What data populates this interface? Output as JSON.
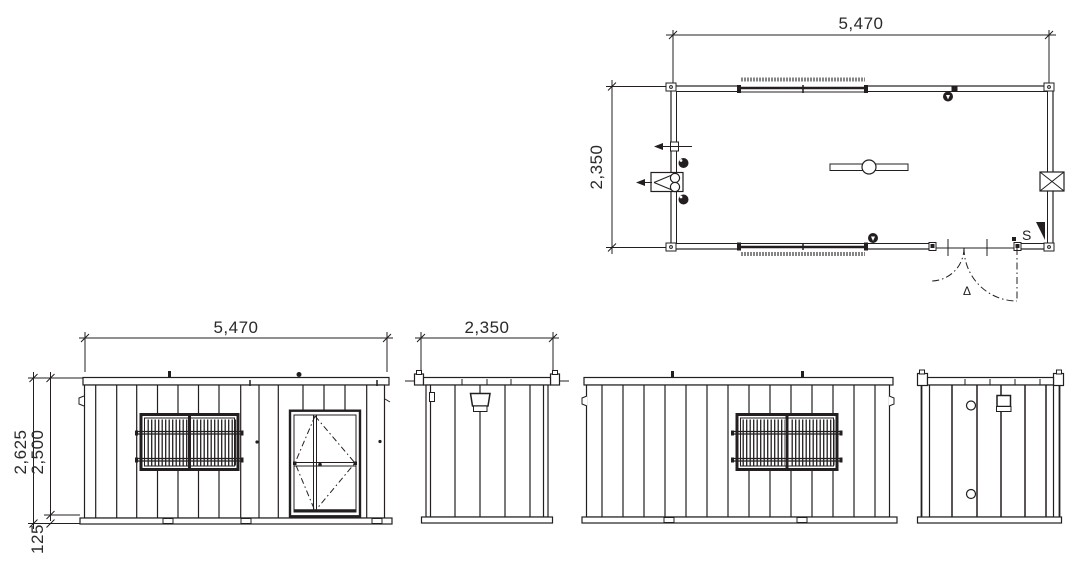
{
  "drawing": {
    "plan": {
      "width_label": "5,470",
      "depth_label": "2,350",
      "switch_label": "S",
      "door_swing_label": "Δ"
    },
    "front_elevation": {
      "width_label": "5,470",
      "total_height_label": "2,625",
      "body_height_label": "2,500",
      "skid_height_label": "125"
    },
    "end_elevation_a": {
      "width_label": "2,350"
    }
  },
  "colors": {
    "ink": "#231f20",
    "background": "#ffffff"
  }
}
